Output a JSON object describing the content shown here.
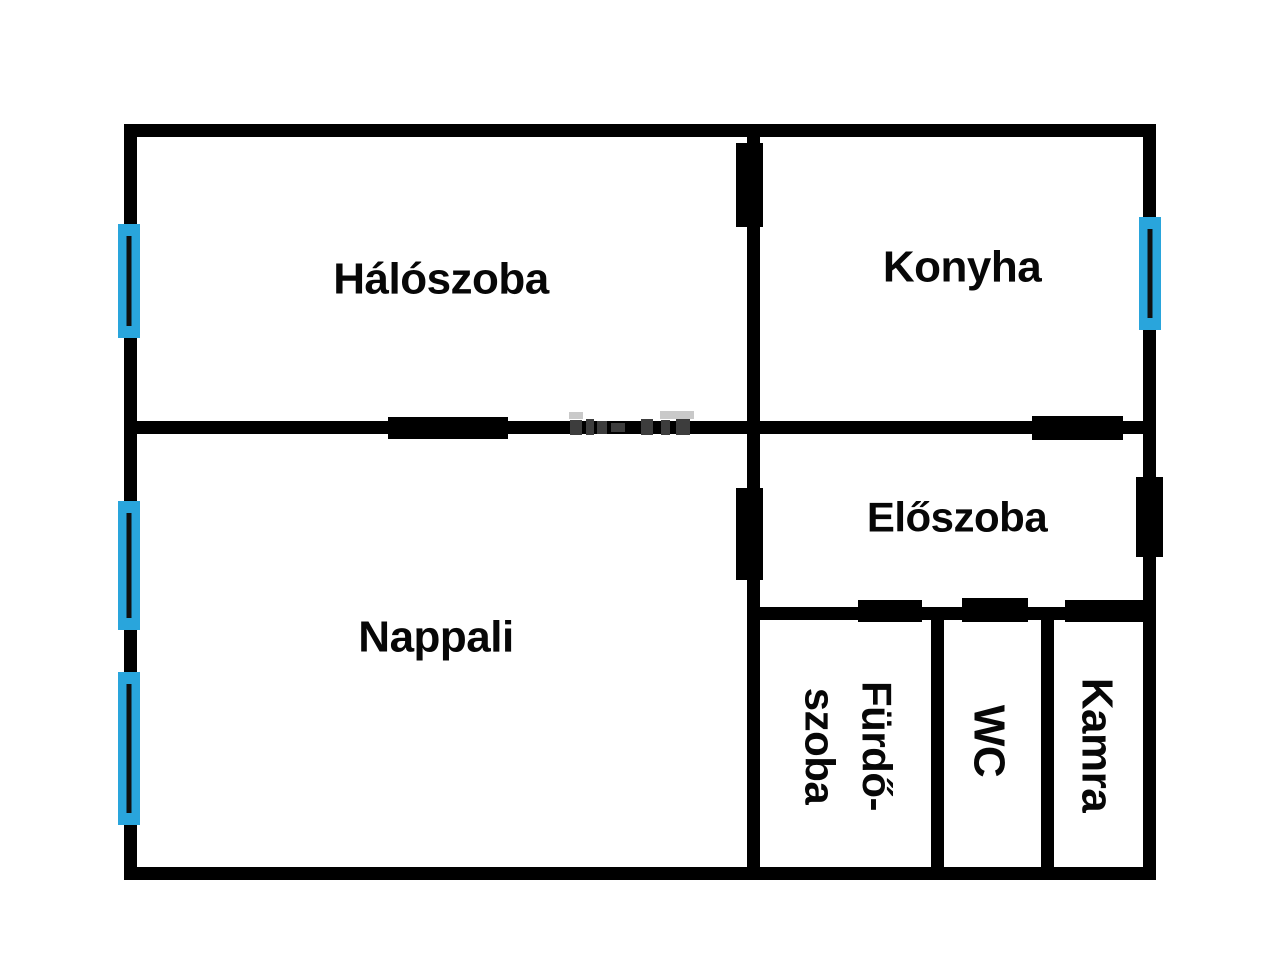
{
  "plan": {
    "canvas": {
      "width": 1280,
      "height": 972,
      "background": "#ffffff"
    },
    "wall_color": "#000000",
    "window_color": "#29a5dc",
    "window_pane_color": "#101010",
    "walls": [
      {
        "id": "outer-top",
        "x": 124,
        "y": 124,
        "w": 1032,
        "h": 13
      },
      {
        "id": "outer-left",
        "x": 124,
        "y": 124,
        "w": 13,
        "h": 756
      },
      {
        "id": "outer-right",
        "x": 1143,
        "y": 124,
        "w": 13,
        "h": 756
      },
      {
        "id": "outer-bottom",
        "x": 124,
        "y": 867,
        "w": 1032,
        "h": 13
      },
      {
        "id": "center-vertical",
        "x": 747,
        "y": 124,
        "w": 13,
        "h": 756
      },
      {
        "id": "middle-horizontal",
        "x": 124,
        "y": 421,
        "w": 1032,
        "h": 13
      },
      {
        "id": "hall-bottom",
        "x": 747,
        "y": 607,
        "w": 409,
        "h": 13
      },
      {
        "id": "bathroom-wc",
        "x": 931,
        "y": 607,
        "w": 13,
        "h": 273
      },
      {
        "id": "wc-pantry",
        "x": 1041,
        "y": 607,
        "w": 13,
        "h": 273
      }
    ],
    "doors": [
      {
        "id": "haloszoba-konyha",
        "x": 736,
        "y": 143,
        "w": 27,
        "h": 84
      },
      {
        "id": "haloszoba-nappali",
        "x": 388,
        "y": 417,
        "w": 120,
        "h": 22
      },
      {
        "id": "konyha-eloszoba",
        "x": 1032,
        "y": 416,
        "w": 91,
        "h": 24
      },
      {
        "id": "nappali-eloszoba",
        "x": 736,
        "y": 488,
        "w": 27,
        "h": 92
      },
      {
        "id": "entrance",
        "x": 1136,
        "y": 477,
        "w": 27,
        "h": 80
      },
      {
        "id": "furdoszoba",
        "x": 858,
        "y": 600,
        "w": 64,
        "h": 22
      },
      {
        "id": "wc",
        "x": 962,
        "y": 598,
        "w": 66,
        "h": 24
      },
      {
        "id": "kamra",
        "x": 1065,
        "y": 600,
        "w": 78,
        "h": 22
      }
    ],
    "windows": [
      {
        "id": "haloszoba",
        "x": 118,
        "y": 224,
        "w": 22,
        "h": 114
      },
      {
        "id": "nappali-upper",
        "x": 118,
        "y": 501,
        "w": 22,
        "h": 129
      },
      {
        "id": "nappali-lower",
        "x": 118,
        "y": 672,
        "w": 22,
        "h": 153
      },
      {
        "id": "konyha",
        "x": 1139,
        "y": 217,
        "w": 22,
        "h": 113
      }
    ],
    "watermark_marks": [
      {
        "x": 569,
        "y": 412,
        "w": 14,
        "h": 7,
        "color": "#c9c9c9"
      },
      {
        "x": 660,
        "y": 411,
        "w": 34,
        "h": 8,
        "color": "#c9c9c9"
      },
      {
        "x": 570,
        "y": 420,
        "w": 12,
        "h": 15,
        "color": "#3d3d3d"
      },
      {
        "x": 586,
        "y": 419,
        "w": 8,
        "h": 16,
        "color": "#3d3d3d"
      },
      {
        "x": 597,
        "y": 421,
        "w": 10,
        "h": 13,
        "color": "#3d3d3d"
      },
      {
        "x": 611,
        "y": 423,
        "w": 14,
        "h": 9,
        "color": "#3d3d3d"
      },
      {
        "x": 641,
        "y": 419,
        "w": 12,
        "h": 16,
        "color": "#3d3d3d"
      },
      {
        "x": 661,
        "y": 420,
        "w": 9,
        "h": 15,
        "color": "#3d3d3d"
      },
      {
        "x": 676,
        "y": 419,
        "w": 14,
        "h": 16,
        "color": "#3d3d3d"
      }
    ]
  },
  "rooms": [
    {
      "id": "haloszoba",
      "label": "Hálószoba",
      "cx": 441,
      "cy": 279,
      "rotation": 0,
      "font_size": 44
    },
    {
      "id": "konyha",
      "label": "Konyha",
      "cx": 962,
      "cy": 267,
      "rotation": 0,
      "font_size": 44
    },
    {
      "id": "nappali",
      "label": "Nappali",
      "cx": 436,
      "cy": 637,
      "rotation": 0,
      "font_size": 44
    },
    {
      "id": "eloszoba",
      "label": "Előszoba",
      "cx": 957,
      "cy": 518,
      "rotation": 0,
      "font_size": 42
    },
    {
      "id": "furdoszoba",
      "label": "Fürdő-\nszoba",
      "cx": 848,
      "cy": 746,
      "rotation": 90,
      "font_size": 42
    },
    {
      "id": "wc",
      "label": "WC",
      "cx": 989,
      "cy": 741,
      "rotation": 90,
      "font_size": 44
    },
    {
      "id": "kamra",
      "label": "Kamra",
      "cx": 1097,
      "cy": 745,
      "rotation": 90,
      "font_size": 44
    }
  ]
}
